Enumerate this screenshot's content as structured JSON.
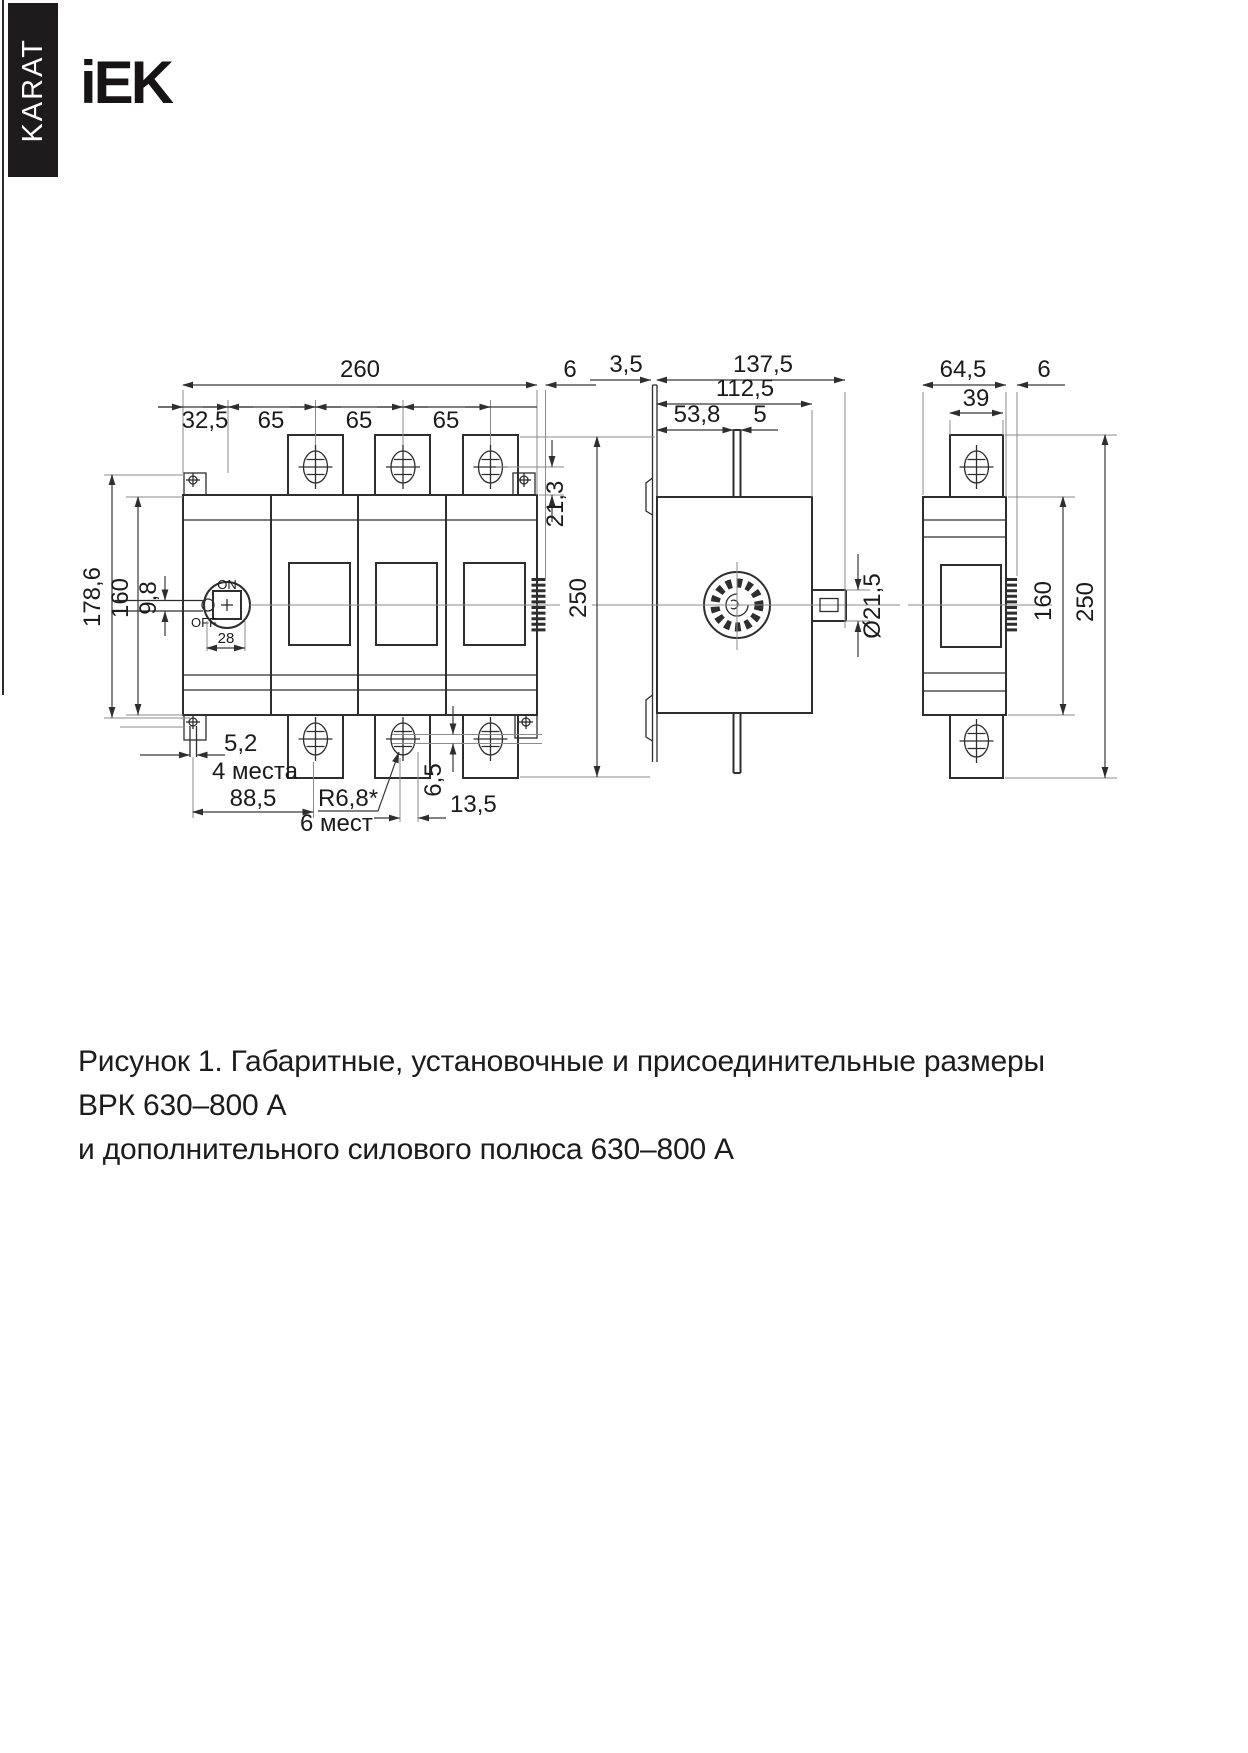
{
  "page": {
    "side_tab": "KARAT",
    "brand": "iEK",
    "caption_line1": "Рисунок 1. Габаритные, установочные и присоединительные размеры ВРК 630–800 А",
    "caption_line2": "и дополнительного силового полюса 630–800 А"
  },
  "front": {
    "width_total": "260",
    "offset_left": "32,5",
    "pitch_1": "65",
    "pitch_2": "65",
    "pitch_3": "65",
    "protrusion": "6",
    "hole_offset": "21,3",
    "mount_height": "178,6",
    "body_height": "160",
    "pad_gap": "9,8",
    "handle_on": "ON",
    "handle_off": "OFF",
    "handle_width": "28",
    "slot_width": "5,2",
    "slot_places": "4 места",
    "mount_pitch": "88,5",
    "hole_radius": "R6,8*",
    "hole_places": "6 мест",
    "hole_offset_v": "6,5",
    "hole_offset_h": "13,5"
  },
  "side": {
    "plate_thickness": "3,5",
    "depth_total": "137,5",
    "depth_mount": "112,5",
    "handle_offset": "53,8",
    "stem_width": "5",
    "height_total": "250",
    "shaft_dia": "Ø21,5"
  },
  "pole": {
    "width_total": "64,5",
    "tab_width": "39",
    "protrusion": "6",
    "body_height": "160",
    "height_total": "250"
  }
}
